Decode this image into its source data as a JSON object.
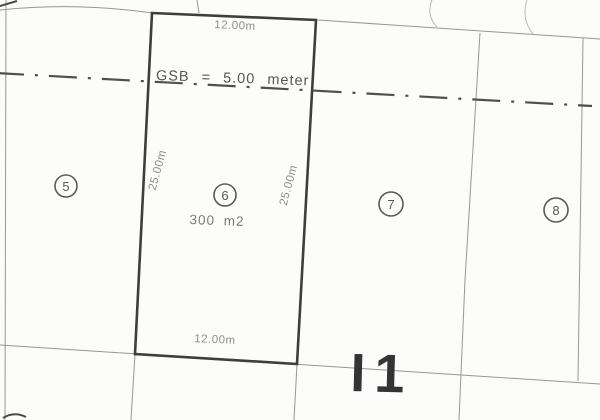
{
  "site_plan": {
    "block_label": "I1",
    "setback": {
      "label": "GSB = 5.00 meter"
    },
    "plot6": {
      "number": "6",
      "area": "300 m2",
      "top_width": "12.00m",
      "bottom_width": "12.00m",
      "left_depth": "25.00m",
      "right_depth": "25.00m"
    },
    "adjacent_plots": {
      "left_number": "5",
      "right_number": "7",
      "far_right_number": "8"
    },
    "colors": {
      "background": "#fcfcfb",
      "thick_boundary": "#3e3e3e",
      "thin_boundary": "#979797",
      "dimension_text": "#8e8e8e",
      "setback_line": "#4f4f4f",
      "block_text": "#343434"
    }
  }
}
